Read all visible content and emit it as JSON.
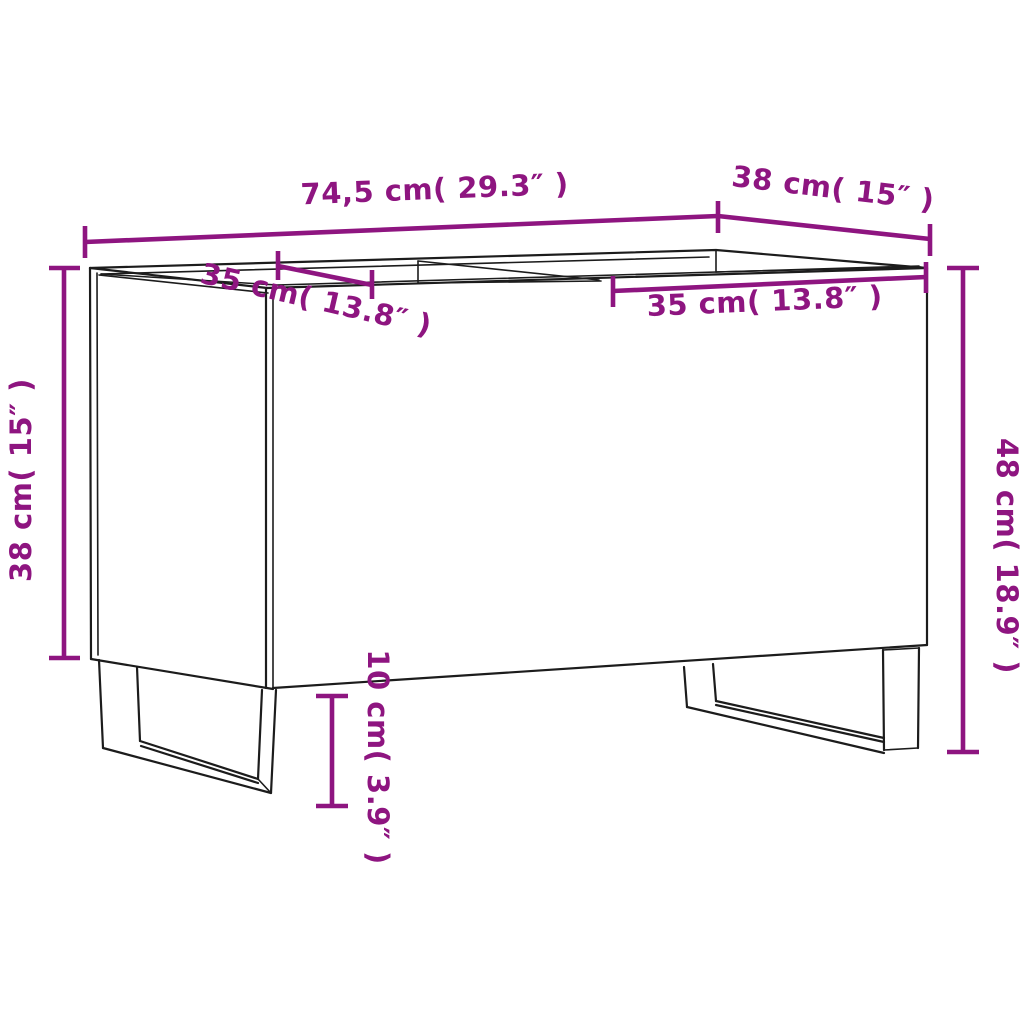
{
  "diagram": {
    "type": "furniture-dimension-diagram",
    "subject": "record cabinet line drawing with open top, two compartments and two sled legs",
    "background_color": "#ffffff",
    "outline_color": "#1c1c1c",
    "dimension_color": "#8e1580"
  },
  "dimensions": [
    {
      "id": "overall-width-top",
      "label": "74,5 cm( 29.3″ )",
      "cm": "74,5",
      "inches": "29.3"
    },
    {
      "id": "depth-top",
      "label": "38 cm( 15″ )",
      "cm": "38",
      "inches": "15"
    },
    {
      "id": "compartment-left",
      "label": "35 cm( 13.8″ )",
      "cm": "35",
      "inches": "13.8"
    },
    {
      "id": "compartment-right",
      "label": "35 cm( 13.8″ )",
      "cm": "35",
      "inches": "13.8"
    },
    {
      "id": "height-left",
      "label": "38 cm( 15″ )",
      "cm": "38",
      "inches": "15"
    },
    {
      "id": "height-right",
      "label": "48 cm( 18.9″ )",
      "cm": "48",
      "inches": "18.9"
    },
    {
      "id": "leg-height",
      "label": "10 cm( 3.9″ )",
      "cm": "10",
      "inches": "3.9"
    }
  ]
}
